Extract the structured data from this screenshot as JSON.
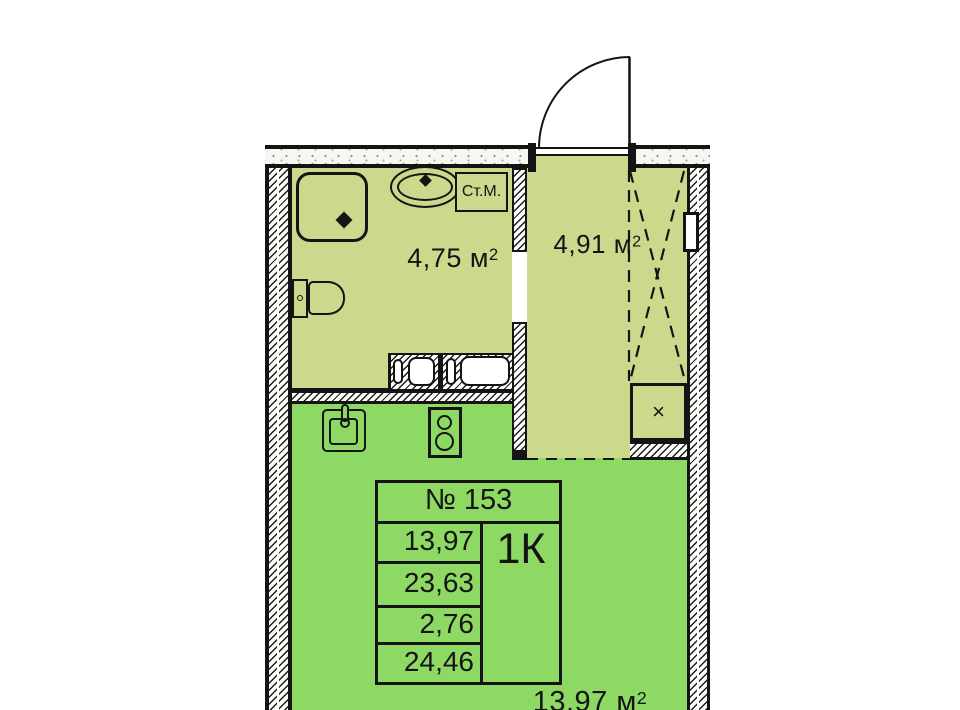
{
  "plan": {
    "apartment_number": "№ 153",
    "apartment_type": "1К",
    "area_rows": [
      "13,97",
      "23,63",
      "2,76",
      "24,46"
    ],
    "rooms": {
      "bathroom": {
        "area": "4,75 м",
        "sup": "2"
      },
      "hall": {
        "area": "4,91 м",
        "sup": "2"
      },
      "living": {
        "area": "13,97 м",
        "sup": "2"
      }
    },
    "labels": {
      "washing_machine": "Ст.М.",
      "vent": "×"
    },
    "colors": {
      "wet_zone_fill": "#cbd98d",
      "room_fill": "#8ed964",
      "line": "#141414"
    }
  }
}
